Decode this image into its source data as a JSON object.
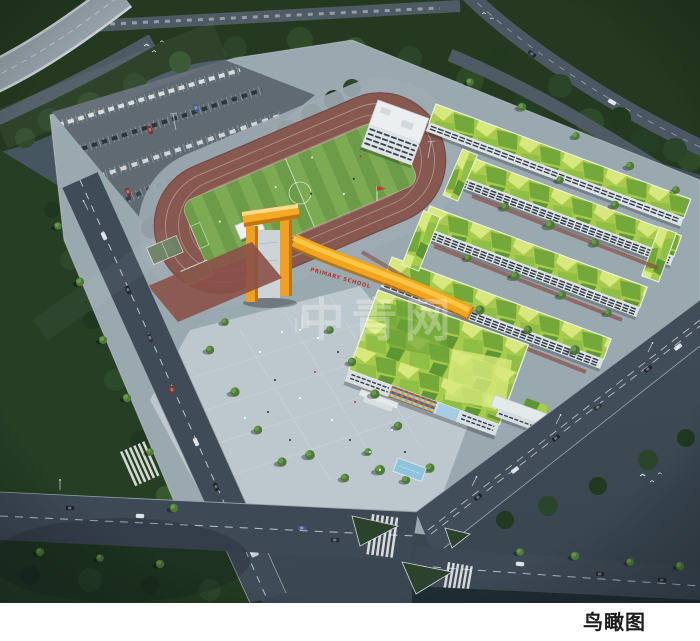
{
  "page": {
    "background_color": "#ffffff",
    "caption": "鸟瞰图"
  },
  "rendering": {
    "subject": "primary-school-campus-aerial-rendering",
    "watermark": {
      "text": "中青网",
      "color": "#ffffff",
      "opacity": 0.3
    },
    "building_sign": {
      "text": "PRIMARY SCHOOL",
      "text_color": "#b5372a",
      "band_color": "#f2a51d"
    },
    "flag_color": "#c23b2a",
    "palette": {
      "ambient": "#46565f",
      "road": "#3f4b57",
      "site_paving": "#9aa8b0",
      "plaza": "#bcc8cd",
      "parking": "#5f6a72",
      "track": "#86584f",
      "field_green_light": "#7cab53",
      "field_green_dark": "#6d9c49",
      "roof_lime": [
        "#d7e87c",
        "#a9cb4d",
        "#8fbf45",
        "#74a83a",
        "#5d9733"
      ],
      "facade_white": "#dce2e6",
      "window_dark": "#333d46",
      "accent_orange": "#f2a51d",
      "accent_orange_dark": "#c17413",
      "tree_dark": "#22381f",
      "tree_bright": "#5e8a42",
      "mosaic": [
        "#2b6fae",
        "#e8502a",
        "#f2c230",
        "#ffffff",
        "#74b8e0"
      ],
      "glass_blue": "#a4cde4",
      "water_blue": "#8fc3dc"
    },
    "features": [
      "highway-viaduct",
      "parking-lot",
      "running-track",
      "soccer-field",
      "basketball-courts",
      "comprehensive-building",
      "teaching-buildings",
      "entrance-tower",
      "entrance-plaza",
      "mosaic-facade",
      "ring-roads",
      "t-intersection",
      "street-trees",
      "birds"
    ]
  }
}
